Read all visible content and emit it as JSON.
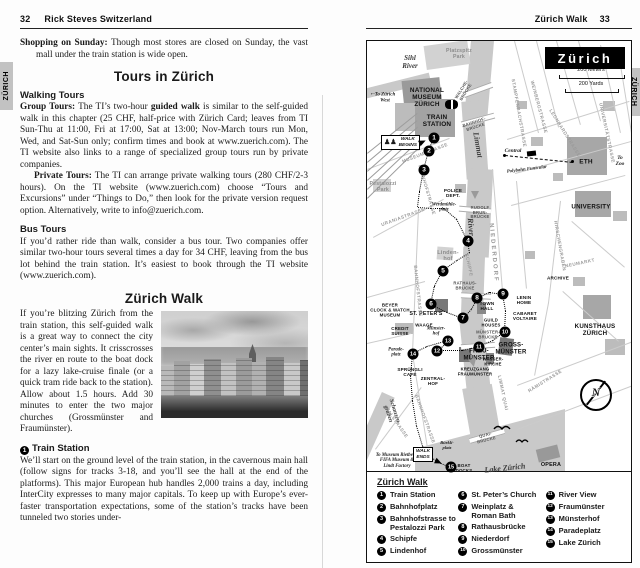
{
  "left": {
    "page_num": "32",
    "book_title": "Rick Steves Switzerland",
    "tab": "ZÜRICH",
    "shopping": [
      {
        "b": true,
        "t": "Shopping on Sunday:"
      },
      {
        "t": " Though most stores are closed on Sunday, the vast mall under the train station is wide open."
      }
    ],
    "tours_heading": "Tours in Zürich",
    "walking_tours_heading": "Walking Tours",
    "group": [
      {
        "b": true,
        "t": "Group Tours:"
      },
      {
        "t": " The TI’s two-hour "
      },
      {
        "b": true,
        "t": "guided walk"
      },
      {
        "t": " is similar to the self-guided walk in this chapter (25 CHF, half-price with Zürich Card; leaves from TI Sun-Thu at 11:00, Fri at 17:00, Sat at 13:00; Nov-March tours run Mon, Wed, and Sat-Sun only; confirm times and book at www.zuerich.com). The TI website also links to a range of specialized group tours run by private companies."
      }
    ],
    "private": [
      {
        "b": true,
        "t": "Private Tours:"
      },
      {
        "t": " The TI can arrange private walking tours (280 CHF/2-3 hours). On the TI website (www.zuerich.com) choose “Tours and Excursions” under “Things to Do,” then look for the private version request option. Alternatively, write to info@zuerich.com."
      }
    ],
    "bus_heading": "Bus Tours",
    "bus": [
      {
        "t": "If you’d rather ride than walk, consider a bus tour. Two companies offer similar two-hour tours several times a day for 34 CHF, leaving from the bus lot behind the train station. It’s easiest to book through the TI website (www.zuerich.com)."
      }
    ],
    "walk_heading": "Zürich Walk",
    "walk_intro": [
      {
        "t": "If you’re blitzing Zürich from the train station, this self-guided walk is a great way to connect the city center’s main sights. It crisscrosses the river en route to the boat dock for a lazy lake-cruise finale (or a quick tram ride back to the station). Allow about 1.5 hours. Add 30 minutes to enter the two major churches (Grossmünster and Fraumünster)."
      }
    ],
    "station_number": "1",
    "station_heading": "Train Station",
    "station_para": [
      {
        "t": "We’ll start on the ground level of the train station, in the cavernous main hall (follow signs for tracks 3-18, and you’ll see the hall at the end of the platforms). This major European hub handles 2,000 trains a day, including InterCity expresses to many major capitals. To keep up with Europe’s ever-faster transportation expectations, some of the station’s tracks have been tunneled two stories under-"
      }
    ]
  },
  "right": {
    "header_title": "Zürich Walk",
    "page_num": "33",
    "tab": "ZÜRICH",
    "map": {
      "title": "Zürich",
      "scale_meters": "200 Meters",
      "scale_yards": "200 Yards",
      "walk_begins": "WALK\nBEGINS",
      "walk_ends": "WALK\nENDS",
      "walk_begins_icon": "♟♟",
      "compass_letter": "N",
      "labels": [
        {
          "t": "Sihl\nRiver",
          "x": 43,
          "y": 22,
          "c": "water"
        },
        {
          "t": "Limmat",
          "x": 110,
          "y": 104,
          "c": "water",
          "r": 80,
          "s": 8
        },
        {
          "t": "River",
          "x": 103,
          "y": 186,
          "c": "water",
          "r": 85,
          "s": 8
        },
        {
          "t": "Lake Zürich",
          "x": 138,
          "y": 428,
          "c": "water",
          "r": -6,
          "s": 8
        },
        {
          "t": "Schanzen-\ngraben",
          "x": 24,
          "y": 372,
          "c": "water",
          "r": 72,
          "s": 6
        },
        {
          "t": "Platzspitz\nPark",
          "x": 92,
          "y": 14,
          "c": "park"
        },
        {
          "t": "Pestalozzi\nPark",
          "x": 16,
          "y": 147,
          "c": "park"
        },
        {
          "t": "Linden-\nhof",
          "x": 81,
          "y": 215,
          "c": "park",
          "s": 5.6
        },
        {
          "t": "NATIONAL\nMUSEUM\nZÜRICH",
          "x": 60,
          "y": 57,
          "c": "poi",
          "s": 6.4
        },
        {
          "t": "TRAIN\nSTATION",
          "x": 70,
          "y": 80,
          "c": "poi",
          "s": 6.4
        },
        {
          "t": "POLICE\nDEPT.",
          "x": 86,
          "y": 152,
          "c": "poi",
          "s": 4.6
        },
        {
          "t": "ST. PETER'S",
          "x": 59,
          "y": 274,
          "c": "poi"
        },
        {
          "t": "BEYER\nCLOCK & WATCH\nMUSEUM",
          "x": 23,
          "y": 270,
          "c": "poi",
          "s": 4.4
        },
        {
          "t": "CREDIT\nSUISSE",
          "x": 33,
          "y": 291,
          "c": "poi",
          "s": 4.4
        },
        {
          "t": "WAAGE",
          "x": 57,
          "y": 285,
          "c": "poi",
          "s": 4.4
        },
        {
          "t": "TOWN\nHALL",
          "x": 120,
          "y": 265,
          "c": "poi",
          "s": 4.6
        },
        {
          "t": "GUILD\nHOUSES",
          "x": 124,
          "y": 282,
          "c": "poi",
          "s": 4.2
        },
        {
          "t": "LENIN\nHOME",
          "x": 157,
          "y": 259,
          "c": "poi",
          "s": 4.6
        },
        {
          "t": "CABARET\nVOLTAIRE",
          "x": 158,
          "y": 275,
          "c": "poi",
          "s": 4.6
        },
        {
          "t": "ARCHIVE",
          "x": 191,
          "y": 237,
          "c": "poi",
          "s": 4.6
        },
        {
          "t": "WASSER-\nKIRCHE",
          "x": 126,
          "y": 321,
          "c": "poi",
          "s": 4.2
        },
        {
          "t": "GROSS-\nMÜNSTER",
          "x": 144,
          "y": 308,
          "c": "poi",
          "s": 6
        },
        {
          "t": "FRAU-\nMÜNSTER",
          "x": 112,
          "y": 314,
          "c": "poi",
          "s": 6
        },
        {
          "t": "KREUZGANG\nFRAUMÜNSTER",
          "x": 108,
          "y": 331,
          "c": "poi",
          "s": 4.2
        },
        {
          "t": "SPRÜNGLI\nCAFÉ",
          "x": 43,
          "y": 331,
          "c": "poi",
          "s": 4.6
        },
        {
          "t": "ZENTRAL-\nHOF",
          "x": 66,
          "y": 340,
          "c": "poi",
          "s": 4.6
        },
        {
          "t": "ETH",
          "x": 219,
          "y": 121,
          "c": "poi",
          "s": 6.5
        },
        {
          "t": "UNIVERSITY",
          "x": 224,
          "y": 167,
          "c": "poi",
          "s": 6.2
        },
        {
          "t": "KUNSTHAUS\nZÜRICH",
          "x": 228,
          "y": 290,
          "c": "poi",
          "s": 6.2
        },
        {
          "t": "OPERA",
          "x": 184,
          "y": 424,
          "c": "poi",
          "s": 5.4
        },
        {
          "t": "BOAT\nDOCKS",
          "x": 97,
          "y": 428,
          "c": "poi",
          "s": 4.4
        },
        {
          "t": "←",
          "x": 6,
          "y": 53,
          "c": "it",
          "s": 7
        },
        {
          "t": "To Zürich\nWest",
          "x": 18,
          "y": 57,
          "c": "it"
        },
        {
          "t": "Central",
          "x": 146,
          "y": 110,
          "c": "it",
          "s": 5.4
        },
        {
          "t": "Polybahn Funicular",
          "x": 160,
          "y": 129,
          "c": "it",
          "r": -7,
          "s": 4.8
        },
        {
          "t": "To\nZoo",
          "x": 253,
          "y": 120,
          "c": "it",
          "s": 5.4
        },
        {
          "t": "Werdmühle-\nplatz",
          "x": 77,
          "y": 167,
          "c": "it",
          "s": 4.8
        },
        {
          "t": "Parade-\nplatz",
          "x": 29,
          "y": 312,
          "c": "it",
          "s": 4.8
        },
        {
          "t": "Münster-\nhof",
          "x": 69,
          "y": 291,
          "c": "it",
          "s": 4.8
        },
        {
          "t": "Bürkli-\nplatz",
          "x": 80,
          "y": 404,
          "c": "it",
          "s": 4.6
        },
        {
          "t": "To Museum Rietberg,\nFIFA Museum &\nLindt Factory",
          "x": 30,
          "y": 420,
          "c": "it",
          "s": 4.8
        },
        {
          "t": "MUSEUMSTRASSE",
          "x": 58,
          "y": 112,
          "c": "street",
          "r": -21
        },
        {
          "t": "BAHNHOFSTRASSE",
          "x": 60,
          "y": 149,
          "c": "street",
          "r": 74
        },
        {
          "t": "BAHNHOFSTRASSE",
          "x": 51,
          "y": 250,
          "c": "street",
          "r": 84
        },
        {
          "t": "BAHNHOFSTRASSE",
          "x": 58,
          "y": 378,
          "c": "street",
          "r": 70
        },
        {
          "t": "URANIASTRASSE",
          "x": 36,
          "y": 176,
          "c": "street",
          "r": -20
        },
        {
          "t": "NIEDERDORF",
          "x": 126,
          "y": 212,
          "c": "street",
          "r": 85,
          "s": 6,
          "ls": 2
        },
        {
          "t": "SCHIPFE",
          "x": 102,
          "y": 224,
          "c": "street",
          "r": 78
        },
        {
          "t": "STAMPFENBACHSTRASSE",
          "x": 152,
          "y": 72,
          "c": "street",
          "r": 80
        },
        {
          "t": "WEINBERGSTRASSE",
          "x": 172,
          "y": 66,
          "c": "street",
          "r": 75
        },
        {
          "t": "LEONHARDSTRASSE",
          "x": 198,
          "y": 92,
          "c": "street",
          "r": 58
        },
        {
          "t": "UNIVERSITÄTSTRASSE",
          "x": 240,
          "y": 92,
          "c": "street",
          "r": 78
        },
        {
          "t": "HIRSCHENGRABEN",
          "x": 193,
          "y": 205,
          "c": "street",
          "r": 80
        },
        {
          "t": "NEUMARKT",
          "x": 213,
          "y": 222,
          "c": "street",
          "r": -12
        },
        {
          "t": "RÄMISTRASSE",
          "x": 178,
          "y": 340,
          "c": "street",
          "r": -32
        },
        {
          "t": "LIMMAT QUAI",
          "x": 136,
          "y": 352,
          "c": "street",
          "r": 78
        },
        {
          "t": "TALSTRASSE",
          "x": 30,
          "y": 382,
          "c": "street",
          "r": 55
        },
        {
          "t": "WALCHE-\nBRÜCKE",
          "x": 97,
          "y": 50,
          "c": "bridge",
          "r": -58
        },
        {
          "t": "BAHNHOF-\nBRÜCKE",
          "x": 108,
          "y": 84,
          "c": "bridge",
          "r": -18
        },
        {
          "t": "RUDOLF\nBRUN-\nBRÜCKE",
          "x": 113,
          "y": 172,
          "c": "bridge"
        },
        {
          "t": "RATHAUS-\nBRÜCKE",
          "x": 98,
          "y": 245,
          "c": "bridge"
        },
        {
          "t": "MÜNSTER-\nBRÜCKE",
          "x": 121,
          "y": 294,
          "c": "bridge"
        },
        {
          "t": "QUAI-\nBRÜCKE",
          "x": 119,
          "y": 397,
          "c": "bridge",
          "r": -14
        }
      ],
      "stops": [
        {
          "n": "1",
          "x": 67,
          "y": 97
        },
        {
          "n": "2",
          "x": 62,
          "y": 110
        },
        {
          "n": "3",
          "x": 57,
          "y": 129
        },
        {
          "n": "4",
          "x": 101,
          "y": 200
        },
        {
          "n": "5",
          "x": 76,
          "y": 230
        },
        {
          "n": "6",
          "x": 64,
          "y": 263
        },
        {
          "n": "7",
          "x": 96,
          "y": 277
        },
        {
          "n": "8",
          "x": 110,
          "y": 257
        },
        {
          "n": "9",
          "x": 136,
          "y": 253
        },
        {
          "n": "10",
          "x": 138,
          "y": 291
        },
        {
          "n": "11",
          "x": 112,
          "y": 306
        },
        {
          "n": "12",
          "x": 70,
          "y": 310
        },
        {
          "n": "13",
          "x": 81,
          "y": 300
        },
        {
          "n": "14",
          "x": 46,
          "y": 313
        },
        {
          "n": "15",
          "x": 84,
          "y": 426
        }
      ]
    },
    "legend": {
      "title": "Zürich Walk",
      "columns": [
        [
          {
            "n": "1",
            "label": "Train Station"
          },
          {
            "n": "2",
            "label": "Bahnhofplatz"
          },
          {
            "n": "3",
            "label": "Bahnhofstrasse to\nPestalozzi Park"
          },
          {
            "n": "4",
            "label": "Schipfe"
          },
          {
            "n": "5",
            "label": "Lindenhof"
          }
        ],
        [
          {
            "n": "6",
            "label": "St. Peter’s Church"
          },
          {
            "n": "7",
            "label": "Weinplatz &\nRoman Bath"
          },
          {
            "n": "8",
            "label": "Rathausbrücke"
          },
          {
            "n": "9",
            "label": "Niederdorf"
          },
          {
            "n": "10",
            "label": "Grossmünster"
          }
        ],
        [
          {
            "n": "11",
            "label": "River View"
          },
          {
            "n": "12",
            "label": "Fraumünster"
          },
          {
            "n": "13",
            "label": "Münsterhof"
          },
          {
            "n": "14",
            "label": "Paradeplatz"
          },
          {
            "n": "15",
            "label": "Lake Zürich"
          }
        ]
      ]
    }
  }
}
